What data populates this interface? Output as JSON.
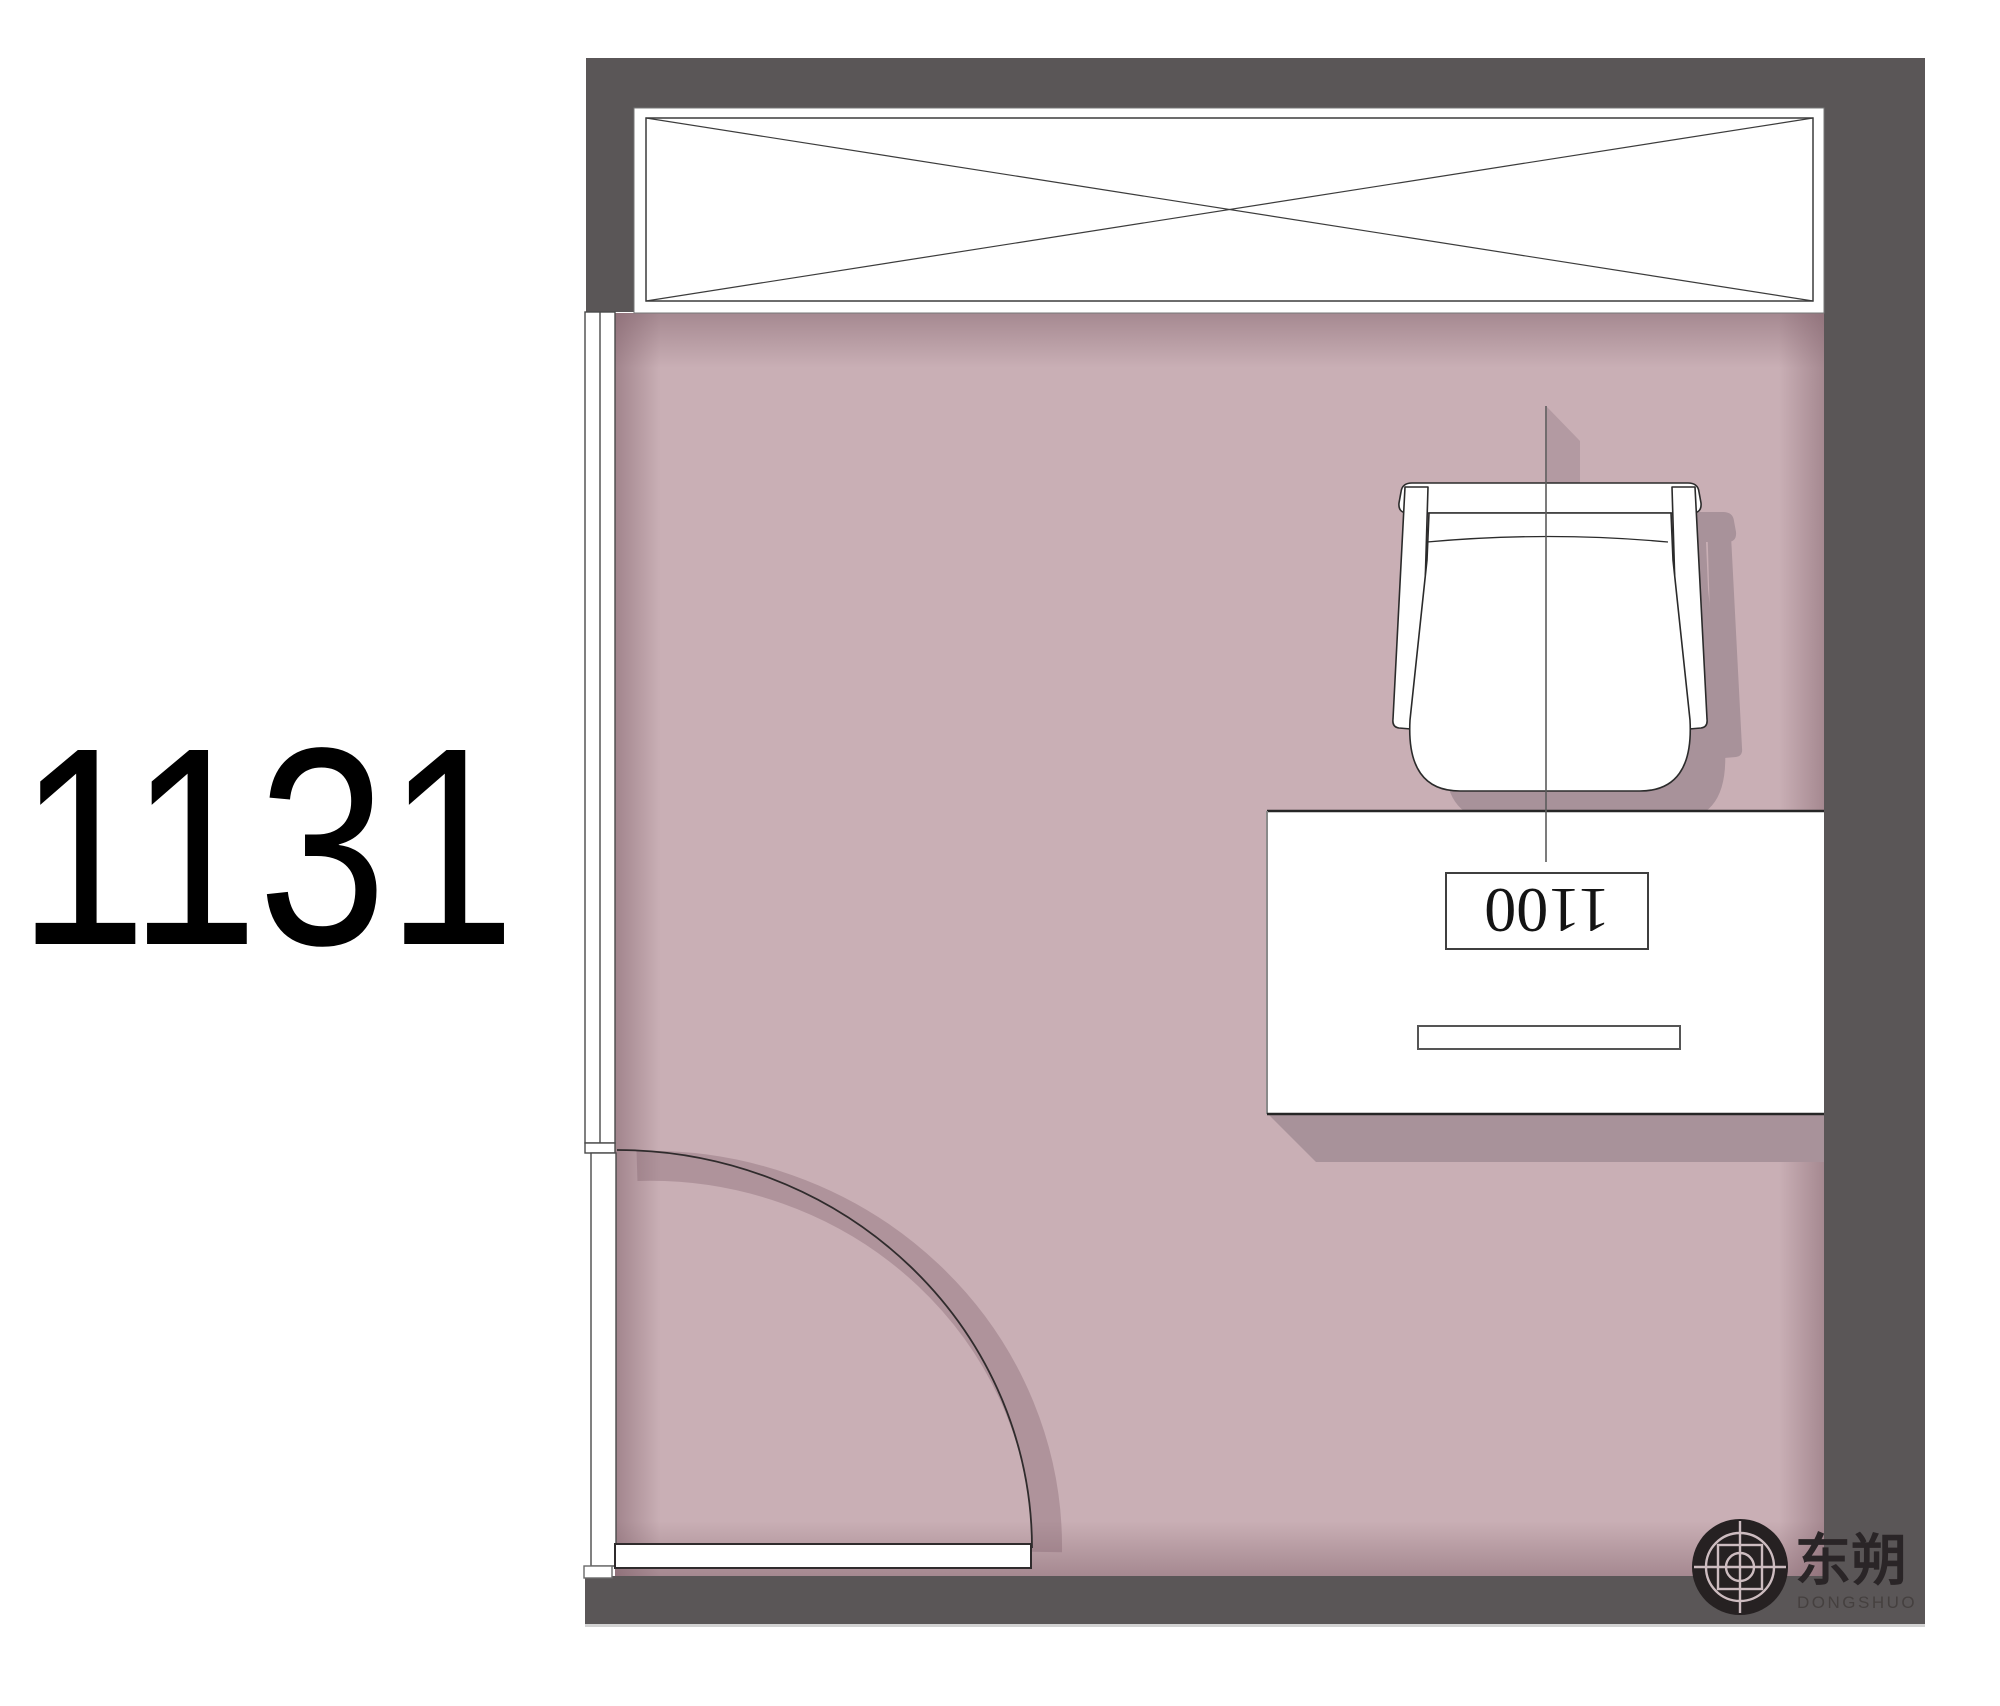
{
  "canvas": {
    "width": 2000,
    "height": 1706,
    "background": "#ffffff"
  },
  "annotation": {
    "room_number": "1131"
  },
  "colors": {
    "wall": "#5a5657",
    "floor": "#c9afb5",
    "floor_edge_shade": "#a8929a",
    "furniture_fill": "#ffffff",
    "line": "#2f2b2c",
    "logo_dark": "#262122"
  },
  "room": {
    "window": {
      "kind": "window-panel-with-x"
    },
    "door": {
      "kind": "single-swing-door-quarter-arc"
    },
    "desk": {
      "width_label": "1100"
    },
    "chair": {
      "kind": "armchair-top-view"
    }
  },
  "logo": {
    "cn": "东朔",
    "en": "DONGSHUO"
  }
}
